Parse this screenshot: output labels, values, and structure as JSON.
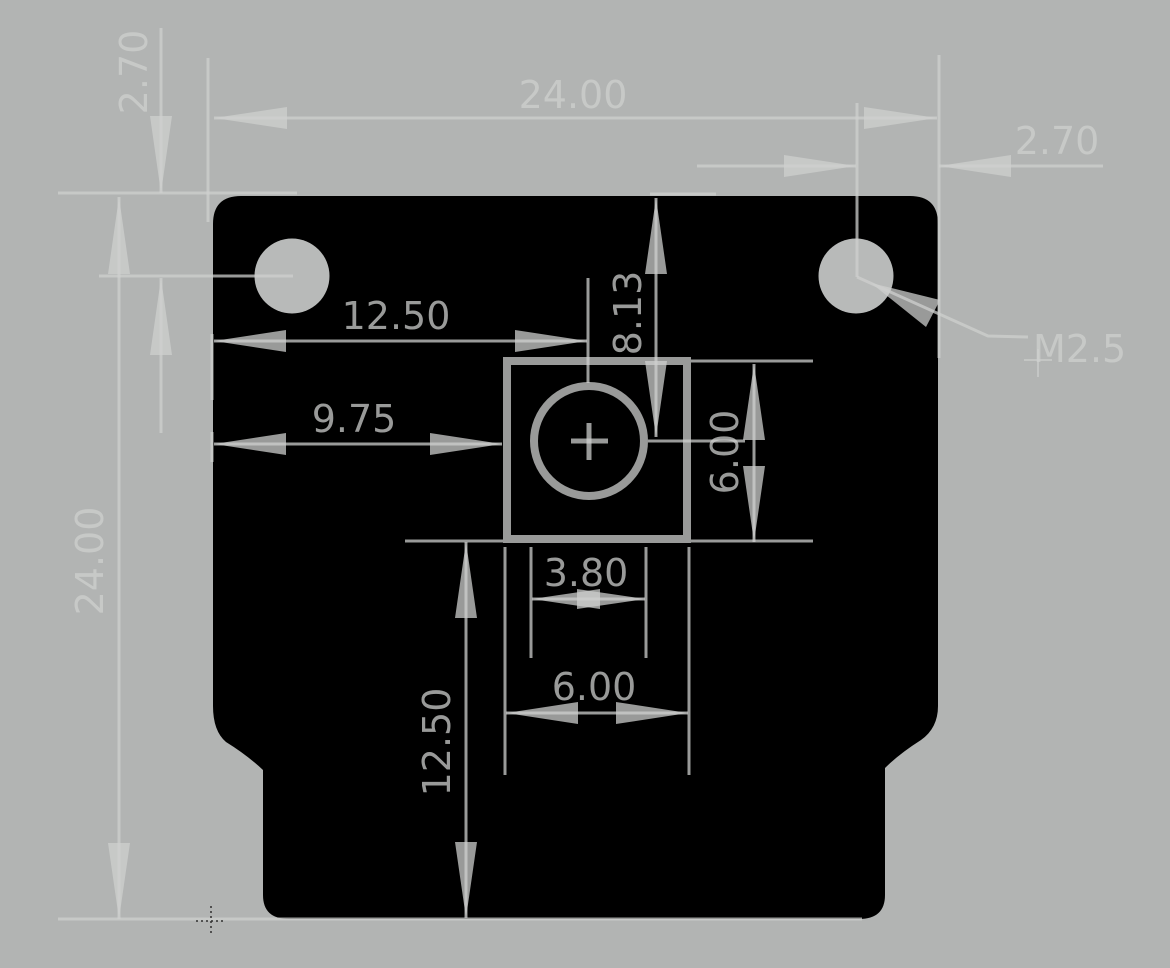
{
  "drawing": {
    "dims": {
      "board_width_top": "24.00",
      "hole_offset_top_left": "2.70",
      "hole_offset_top_right": "2.70",
      "lens_center_from_left_edge": "12.50",
      "sensor_left_from_edge": "9.75",
      "lens_center_from_top_edge": "8.13",
      "sensor_height_right": "6.00",
      "lens_diameter": "3.80",
      "sensor_width_bottom": "6.00",
      "sensor_bottom_to_board_bottom": "12.50",
      "board_height_left": "24.00",
      "mounting_hole_thread": "M2.5"
    },
    "colors": {
      "background": "#b2b4b3",
      "board_silhouette": "#000000",
      "annotation_gray": "#c9cbca",
      "annotation_over_board": "#909291",
      "hole_fill": "#b8bab9"
    }
  }
}
